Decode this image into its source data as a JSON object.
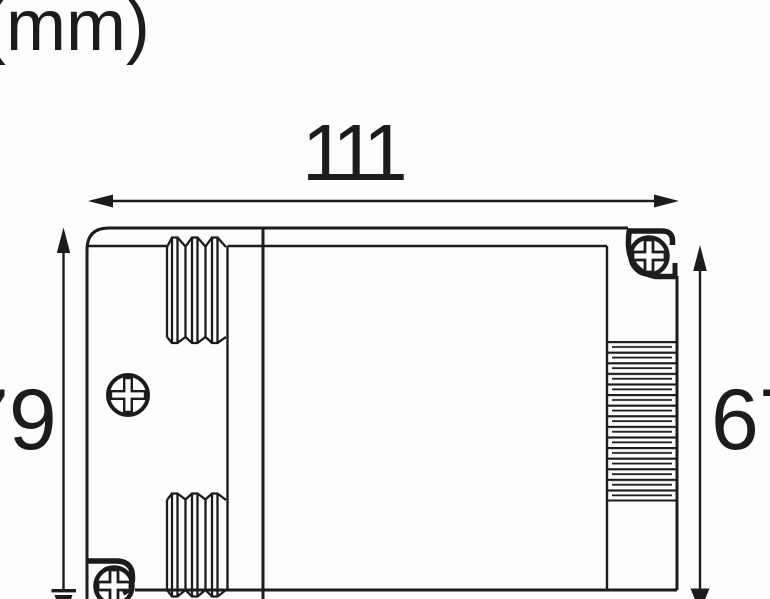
{
  "unit_label": "(mm)",
  "dimensions": {
    "width": {
      "label": "111",
      "value": 111
    },
    "height_left": {
      "label": "79",
      "value": 79
    },
    "height_right": {
      "label": "67",
      "value": 67
    }
  },
  "figure": {
    "type": "technical-dimension-drawing",
    "line_color": "#1c1c1a",
    "background": "#fdfdfc",
    "icons": [
      "phillips-screw-icon",
      "strain-relief-ribs",
      "heatsink-ribs",
      "dimension-arrow"
    ]
  }
}
